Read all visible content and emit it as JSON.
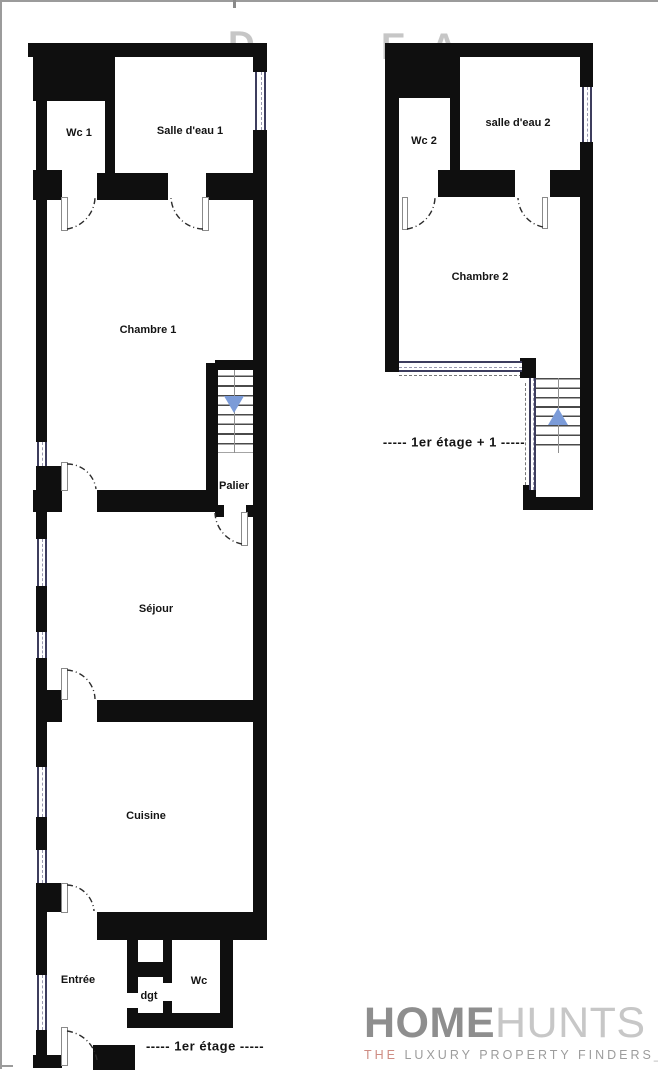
{
  "watermark": {
    "left_fragment": "D",
    "right_fragment": "E A"
  },
  "floor1": {
    "caption": "-----  1er étage  -----",
    "rooms": {
      "wc1": "Wc 1",
      "salle_deau_1": "Salle d'eau 1",
      "chambre1": "Chambre 1",
      "palier": "Palier",
      "sejour": "Séjour",
      "cuisine": "Cuisine",
      "entree": "Entrée",
      "dgt": "dgt",
      "wc": "Wc"
    }
  },
  "floor2": {
    "caption": "-----  1er étage + 1  -----",
    "rooms": {
      "wc2": "Wc 2",
      "salle_deau_2": "salle d'eau 2",
      "chambre2": "Chambre 2"
    }
  },
  "stairs": {
    "floor1_direction": "down",
    "floor2_direction": "up"
  },
  "logo": {
    "home": "HOME",
    "hunts": "HUNTS",
    "tagline_the": "THE",
    "tagline_rest": "LUXURY PROPERTY FINDERS",
    "cursor": "_"
  },
  "colors": {
    "wall": "#0f0f0f",
    "stair_arrow_blue": "#7b9bd8",
    "window_frame": "#3d3d5e",
    "watermark_gray": "#c6c6c6",
    "logo_home_gray": "#8e8e8e",
    "logo_hunts_gray": "#c7c7c7",
    "logo_the_salmon": "#ce8c83",
    "logo_tagline_gray": "#9c9c9c"
  }
}
